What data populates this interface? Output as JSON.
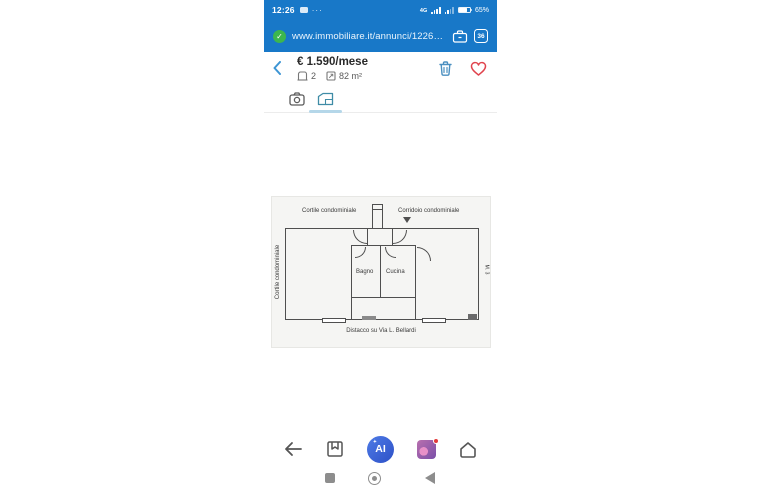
{
  "colors": {
    "browser_blue": "#1878c8",
    "shield_green": "#3cb64e",
    "trash_blue": "#4a8fc0",
    "heart_red": "#e0434d",
    "tab_active_teal": "#3f8ca6",
    "ai_blue": "#2d50c7",
    "nav_gray": "#8d8d8d"
  },
  "status_bar": {
    "time": "12:26",
    "more_indicator": "···",
    "network": "4G",
    "battery": "65%"
  },
  "browser_bar": {
    "url": "www.immobiliare.it/annunci/122671370/?u",
    "tab_count": "36"
  },
  "listing_header": {
    "price": "€ 1.590/mese",
    "rooms_count": "2",
    "area": "82 m²"
  },
  "tabs": {
    "active": "floorplan"
  },
  "floorplan": {
    "top_left_label": "Cortile condominiale",
    "top_right_label": "Corridoio condominiale",
    "left_label": "Cortile condominiale",
    "bathroom_label": "Bagno",
    "kitchen_label": "Cucina",
    "bottom_label": "Distacco su Via L. Bellardi",
    "right_label": "M. 3"
  },
  "bottom_nav": {
    "ai_label": "AI",
    "sparkle": "✦"
  },
  "icons": {
    "shield_check": "✓"
  }
}
